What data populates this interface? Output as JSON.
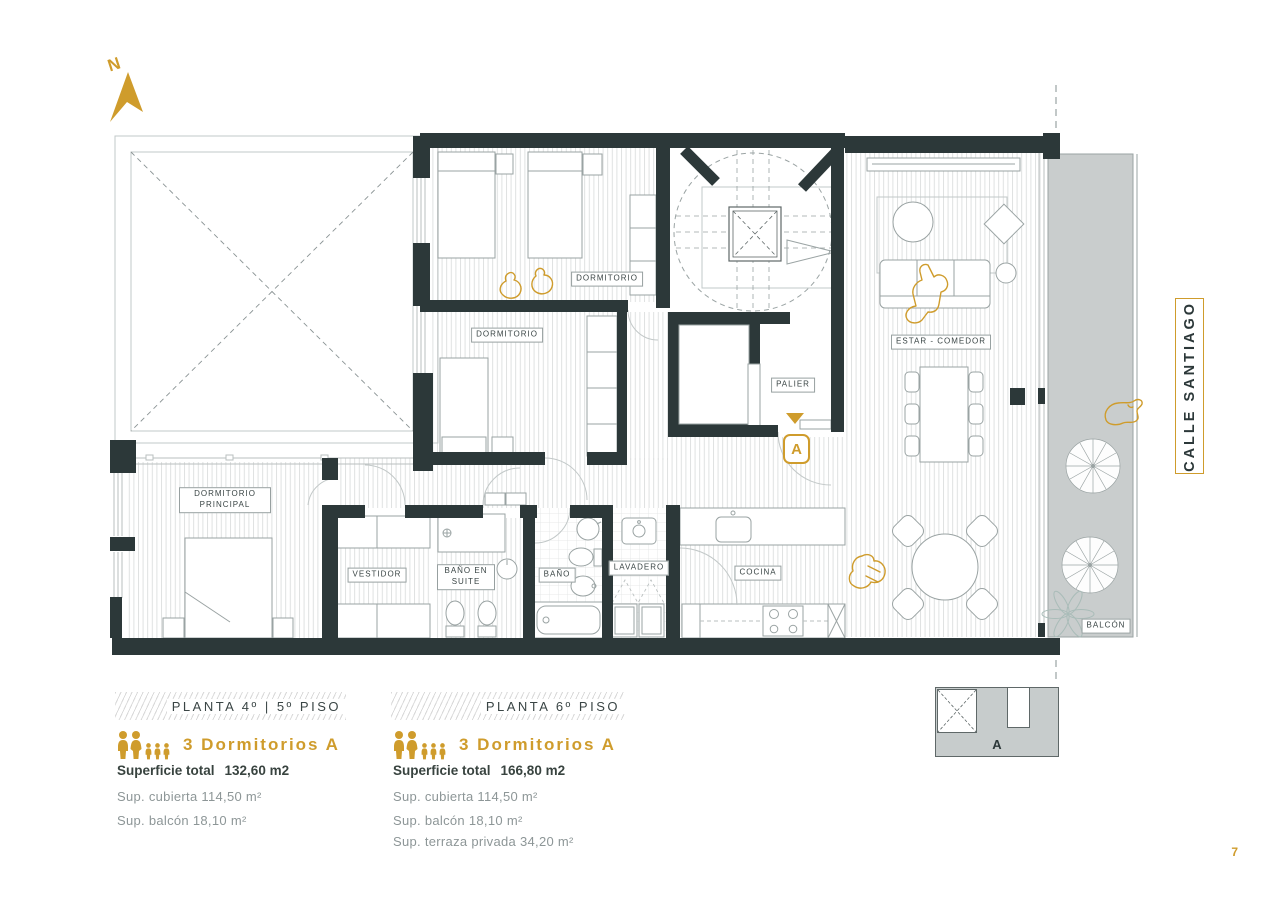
{
  "north": {
    "label": "N"
  },
  "street_sign": {
    "label": "CALLE SANTIAGO"
  },
  "plan": {
    "labels": {
      "bedroom_top": "DORMITORIO",
      "bedroom_mid": "DORMITORIO",
      "master_bedroom": "DORMITORIO PRINCIPAL",
      "dressing_room": "VESTIDOR",
      "ensuite_bath": "BAÑO EN SUITE",
      "bathroom": "BAÑO",
      "laundry": "LAVADERO",
      "kitchen": "COCINA",
      "landing": "PALIER",
      "living_dining": "ESTAR - COMEDOR",
      "balcony": "BALCÓN"
    },
    "entry_marker": "A"
  },
  "legends": [
    {
      "floor_title": "PLANTA 4º | 5º PISO",
      "unit_name": "3 Dormitorios A",
      "total_label": "Superficie total",
      "total_value": "132,60 m2",
      "details": [
        "Sup. cubierta 114,50 m²",
        "Sup. balcón 18,10 m²"
      ]
    },
    {
      "floor_title": "PLANTA 6º PISO",
      "unit_name": "3 Dormitorios A",
      "total_label": "Superficie total",
      "total_value": "166,80 m2",
      "details": [
        "Sup. cubierta 114,50 m²",
        "Sup. balcón 18,10 m²",
        "Sup. terraza privada 34,20 m²"
      ]
    }
  ],
  "key_plan": {
    "unit_letter": "A"
  },
  "page": {
    "number": "7"
  },
  "colors": {
    "accent_gold": "#cf9c2c",
    "wall": "#2c3839",
    "balcony": "#c9cdcd"
  }
}
